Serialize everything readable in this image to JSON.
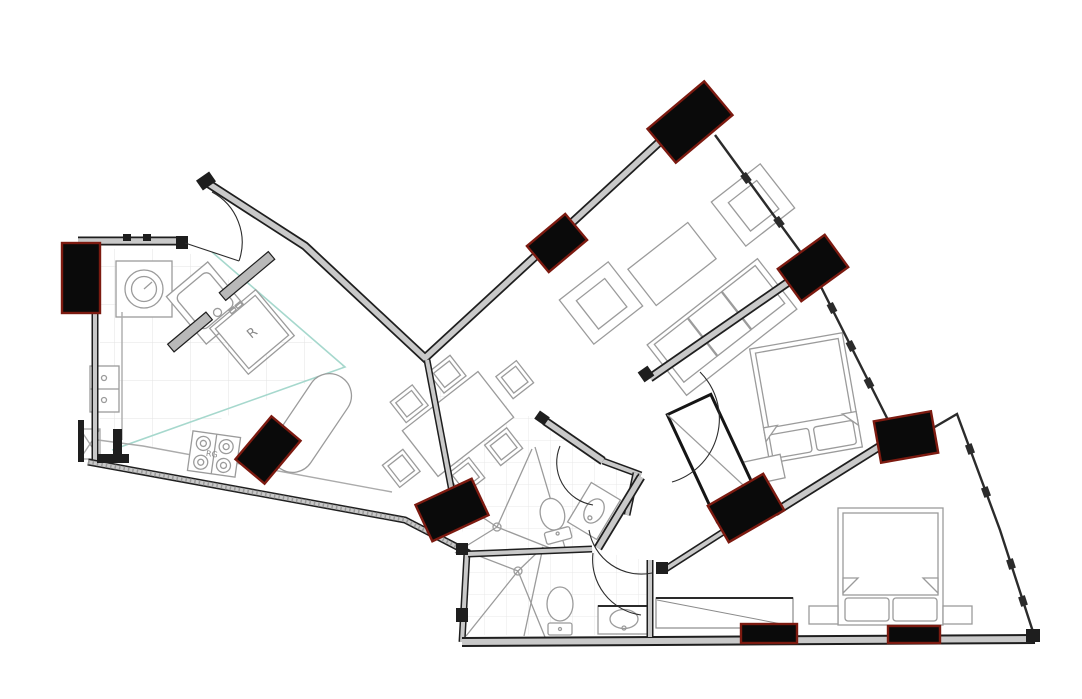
{
  "page": {
    "title": "Apartment floor plan drawing"
  },
  "labels": {
    "refrigerator": "R",
    "range": "RG"
  },
  "colors": {
    "background": "#ffffff",
    "wallEdge": "#1e1e1e",
    "wallFill": "#c9c9c9",
    "windowLine": "#2b2b2b",
    "columnFill": "#0a0a0a",
    "columnEdge": "#7c1a10",
    "furnitureLine": "#9b9b9b",
    "counterLine": "#ababab",
    "tileLine": "#e3e3e3",
    "kitchenBoundary": "#a6d8cd",
    "doorArc": "#2c2c2c"
  },
  "rooms": [
    {
      "name": "entry"
    },
    {
      "name": "kitchen"
    },
    {
      "name": "dining-area"
    },
    {
      "name": "living-room"
    },
    {
      "name": "bathroom-1"
    },
    {
      "name": "bathroom-2"
    },
    {
      "name": "hall"
    },
    {
      "name": "bedroom-1"
    },
    {
      "name": "bedroom-2"
    },
    {
      "name": "closet"
    }
  ],
  "fixtures": [
    "washer",
    "angled-kitchen-sink",
    "refrigerator",
    "range",
    "double-sink",
    "island-counter",
    "dining-table",
    "dining-chairs",
    "sofa",
    "coffee-table",
    "armchairs",
    "beds",
    "nightstands",
    "wardrobe",
    "closet-rod",
    "toilets",
    "vanities",
    "shower-drains"
  ]
}
